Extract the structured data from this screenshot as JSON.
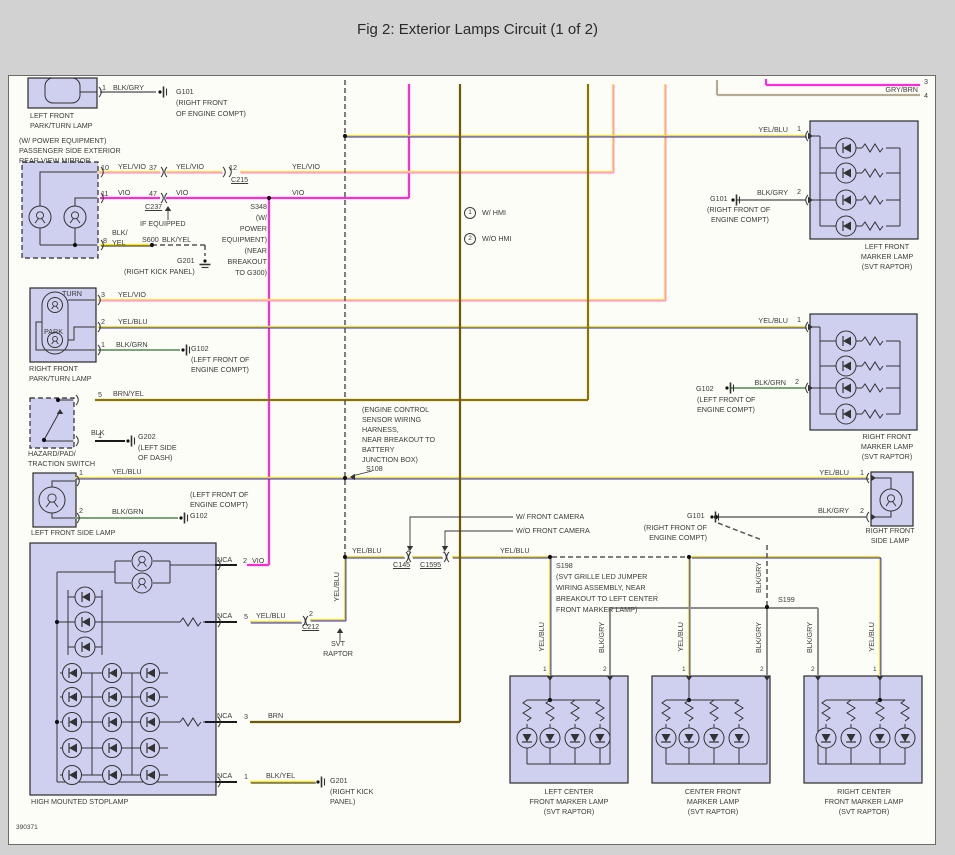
{
  "title": "Fig 2: Exterior Lamps Circuit (1 of 2)",
  "figure_number": "390371",
  "colors": {
    "page_bg": "#d2d2d2",
    "paper": "#fdfdf8",
    "paper_border": "#6a6a6a",
    "ink": "#333333",
    "text": "#3a3a3a",
    "box_fill": "#cfcfef",
    "box_stroke": "#2b2b2b",
    "vio": "#ff2bd6",
    "yelvio_base": "#ffd95e",
    "yelvio_stripe": "#ff7bdc",
    "yelblu_base": "#efdf2e",
    "yelblu_stripe": "#2a2ac8",
    "blkyel_base": "#ffe81a",
    "blkyel_stripe": "#222222",
    "brnyel": "#8a7500",
    "brn": "#6e5900",
    "blk": "#1a1a1a",
    "blkgry": "#8d8d8d",
    "blkgrn": "#7da37d",
    "grybrn": "#b5ab92",
    "dash": "#555555"
  },
  "components": [
    "LEFT FRONT PARK/TURN LAMP",
    "PASSENGER SIDE EXTERIOR REAR VIEW MIRROR (W/ POWER EQUIPMENT)",
    "RIGHT FRONT PARK/TURN LAMP",
    "HAZARD/PAD/TRACTION SWITCH",
    "LEFT FRONT SIDE LAMP",
    "HIGH MOUNTED STOPLAMP",
    "LEFT FRONT MARKER LAMP (SVT RAPTOR)",
    "RIGHT FRONT MARKER LAMP (SVT RAPTOR)",
    "RIGHT FRONT SIDE LAMP",
    "LEFT CENTER FRONT MARKER LAMP (SVT RAPTOR)",
    "CENTER FRONT MARKER LAMP (SVT RAPTOR)",
    "RIGHT CENTER FRONT MARKER LAMP (SVT RAPTOR)"
  ],
  "labels": [
    {
      "n": "a-pin-1",
      "t": "1",
      "x": 102,
      "y": 84
    },
    {
      "n": "a-wire-color",
      "t": "BLK/GRY",
      "x": 113,
      "y": 84
    },
    {
      "n": "g101-a",
      "t": "G101",
      "x": 176,
      "y": 88
    },
    {
      "n": "g101-a-loc1",
      "t": "(RIGHT FRONT",
      "x": 176,
      "y": 99
    },
    {
      "n": "g101-a-loc2",
      "t": "OF ENGINE COMPT)",
      "x": 176,
      "y": 110
    },
    {
      "n": "a-caption1",
      "t": "LEFT FRONT",
      "x": 30,
      "y": 112
    },
    {
      "n": "a-caption2",
      "t": "PARK/TURN LAMP",
      "x": 30,
      "y": 122
    },
    {
      "n": "mirror-caption1",
      "t": "(W/ POWER EQUIPMENT)",
      "x": 19,
      "y": 137
    },
    {
      "n": "mirror-caption2",
      "t": "PASSENGER SIDE EXTERIOR",
      "x": 19,
      "y": 147
    },
    {
      "n": "mirror-caption3",
      "t": "REAR VIEW MIRROR",
      "x": 19,
      "y": 157
    },
    {
      "n": "mirror-pin-10",
      "t": "10",
      "x": 101,
      "y": 164
    },
    {
      "n": "w-yelvio-1",
      "t": "YEL/VIO",
      "x": 118,
      "y": 163
    },
    {
      "n": "pin-37",
      "t": "37",
      "x": 149,
      "y": 164
    },
    {
      "n": "w-yelvio-2",
      "t": "YEL/VIO",
      "x": 176,
      "y": 163
    },
    {
      "n": "pin-12",
      "t": "12",
      "x": 229,
      "y": 164
    },
    {
      "n": "conn-c215",
      "t": "C215",
      "x": 231,
      "y": 176,
      "u": 1
    },
    {
      "n": "w-yelvio-3",
      "t": "YEL/VIO",
      "x": 292,
      "y": 163
    },
    {
      "n": "mirror-pin-11",
      "t": "11",
      "x": 101,
      "y": 190
    },
    {
      "n": "w-vio-1",
      "t": "VIO",
      "x": 118,
      "y": 189
    },
    {
      "n": "pin-47",
      "t": "47",
      "x": 149,
      "y": 190
    },
    {
      "n": "w-vio-2",
      "t": "VIO",
      "x": 176,
      "y": 189
    },
    {
      "n": "conn-c237",
      "t": "C237",
      "x": 145,
      "y": 203,
      "u": 1
    },
    {
      "n": "w-vio-3",
      "t": "VIO",
      "x": 292,
      "y": 189
    },
    {
      "n": "note-if-equipped",
      "t": "IF EQUIPPED",
      "x": 140,
      "y": 220
    },
    {
      "n": "mirror-pin-8",
      "t": "8",
      "x": 103,
      "y": 237
    },
    {
      "n": "w-blkyel-1a",
      "t": "BLK/",
      "x": 112,
      "y": 229
    },
    {
      "n": "w-blkyel-1b",
      "t": "YEL",
      "x": 112,
      "y": 239
    },
    {
      "n": "splice-s600",
      "t": "S600",
      "x": 142,
      "y": 236
    },
    {
      "n": "w-blkyel-2",
      "t": "BLK/YEL",
      "x": 162,
      "y": 236
    },
    {
      "n": "g201-a",
      "t": "G201",
      "x": 177,
      "y": 257
    },
    {
      "n": "g201-a-loc",
      "t": "(RIGHT KICK PANEL)",
      "x": 124,
      "y": 268
    },
    {
      "n": "splice-s348",
      "t": "S348",
      "x": 267,
      "y": 203,
      "a": "r"
    },
    {
      "n": "s348-note1",
      "t": "(W/",
      "x": 267,
      "y": 214,
      "a": "r"
    },
    {
      "n": "s348-note2",
      "t": "POWER",
      "x": 267,
      "y": 225,
      "a": "r"
    },
    {
      "n": "s348-note3",
      "t": "EQUIPMENT)",
      "x": 267,
      "y": 236,
      "a": "r"
    },
    {
      "n": "s348-note4",
      "t": "(NEAR",
      "x": 267,
      "y": 247,
      "a": "r"
    },
    {
      "n": "s348-note5",
      "t": "BREAKOUT",
      "x": 267,
      "y": 258,
      "a": "r"
    },
    {
      "n": "s348-note6",
      "t": "TO G300)",
      "x": 267,
      "y": 269,
      "a": "r"
    },
    {
      "n": "note-1-marker",
      "t": "1",
      "x": 464,
      "y": 207,
      "circ": 1
    },
    {
      "n": "note-1-text",
      "t": "W/ HMI",
      "x": 482,
      "y": 209
    },
    {
      "n": "note-2-marker",
      "t": "2",
      "x": 464,
      "y": 233,
      "circ": 1
    },
    {
      "n": "note-2-text",
      "t": "W/O HMI",
      "x": 482,
      "y": 235
    },
    {
      "n": "edge-pin-3",
      "t": "3",
      "x": 924,
      "y": 78
    },
    {
      "n": "w-grybrn",
      "t": "GRY/BRN",
      "x": 918,
      "y": 86,
      "a": "r"
    },
    {
      "n": "edge-pin-4",
      "t": "4",
      "x": 924,
      "y": 92
    },
    {
      "n": "w-yelblu-lfm",
      "t": "YEL/BLU",
      "x": 788,
      "y": 126,
      "a": "r"
    },
    {
      "n": "lfm-pin-1",
      "t": "1",
      "x": 797,
      "y": 125
    },
    {
      "n": "g101-b",
      "t": "G101",
      "x": 710,
      "y": 195
    },
    {
      "n": "w-blkgry-lfm",
      "t": "BLK/GRY",
      "x": 788,
      "y": 189,
      "a": "r"
    },
    {
      "n": "lfm-pin-2",
      "t": "2",
      "x": 797,
      "y": 188
    },
    {
      "n": "g101-b-loc1",
      "t": "(RIGHT FRONT OF",
      "x": 707,
      "y": 206
    },
    {
      "n": "g101-b-loc2",
      "t": "ENGINE COMPT)",
      "x": 711,
      "y": 216
    },
    {
      "n": "lfm-caption1",
      "t": "LEFT FRONT",
      "x": 887,
      "y": 243,
      "a": "c"
    },
    {
      "n": "lfm-caption2",
      "t": "MARKER LAMP",
      "x": 887,
      "y": 253,
      "a": "c"
    },
    {
      "n": "lfm-caption3",
      "t": "(SVT RAPTOR)",
      "x": 887,
      "y": 263,
      "a": "c"
    },
    {
      "n": "c-turn",
      "t": "TURN",
      "x": 62,
      "y": 290
    },
    {
      "n": "c-park",
      "t": "PARK",
      "x": 44,
      "y": 328
    },
    {
      "n": "c-pin-3",
      "t": "3",
      "x": 101,
      "y": 291
    },
    {
      "n": "w-yelvio-4",
      "t": "YEL/VIO",
      "x": 118,
      "y": 291
    },
    {
      "n": "c-pin-2",
      "t": "2",
      "x": 101,
      "y": 318
    },
    {
      "n": "w-yelblu-1",
      "t": "YEL/BLU",
      "x": 118,
      "y": 318
    },
    {
      "n": "c-pin-1",
      "t": "1",
      "x": 101,
      "y": 341
    },
    {
      "n": "w-blkgrn-1",
      "t": "BLK/GRN",
      "x": 116,
      "y": 341
    },
    {
      "n": "g102-a",
      "t": "G102",
      "x": 191,
      "y": 345
    },
    {
      "n": "g102-a-loc1",
      "t": "(LEFT FRONT OF",
      "x": 191,
      "y": 356
    },
    {
      "n": "g102-a-loc2",
      "t": "ENGINE COMPT)",
      "x": 191,
      "y": 366
    },
    {
      "n": "c-caption1",
      "t": "RIGHT FRONT",
      "x": 29,
      "y": 365
    },
    {
      "n": "c-caption2",
      "t": "PARK/TURN LAMP",
      "x": 29,
      "y": 375
    },
    {
      "n": "w-yelblu-rfm",
      "t": "YEL/BLU",
      "x": 788,
      "y": 317,
      "a": "r"
    },
    {
      "n": "rfm-pin-1",
      "t": "1",
      "x": 797,
      "y": 316
    },
    {
      "n": "g102-b",
      "t": "G102",
      "x": 696,
      "y": 385
    },
    {
      "n": "w-blkgrn-rfm",
      "t": "BLK/GRN",
      "x": 786,
      "y": 379,
      "a": "r"
    },
    {
      "n": "rfm-pin-2",
      "t": "2",
      "x": 795,
      "y": 378
    },
    {
      "n": "g102-b-loc1",
      "t": "(LEFT FRONT OF",
      "x": 697,
      "y": 396
    },
    {
      "n": "g102-b-loc2",
      "t": "ENGINE COMPT)",
      "x": 697,
      "y": 406
    },
    {
      "n": "rfm-caption1",
      "t": "RIGHT FRONT",
      "x": 887,
      "y": 433,
      "a": "c"
    },
    {
      "n": "rfm-caption2",
      "t": "MARKER LAMP",
      "x": 887,
      "y": 443,
      "a": "c"
    },
    {
      "n": "rfm-caption3",
      "t": "(SVT RAPTOR)",
      "x": 887,
      "y": 453,
      "a": "c"
    },
    {
      "n": "hz-pin-5",
      "t": "5",
      "x": 98,
      "y": 391
    },
    {
      "n": "w-brnyel",
      "t": "BRN/YEL",
      "x": 113,
      "y": 390
    },
    {
      "n": "hz-pin-1",
      "t": "1",
      "x": 98,
      "y": 432
    },
    {
      "n": "w-blk",
      "t": "BLK",
      "x": 91,
      "y": 429
    },
    {
      "n": "g202",
      "t": "G202",
      "x": 138,
      "y": 433
    },
    {
      "n": "g202-loc1",
      "t": "(LEFT SIDE",
      "x": 138,
      "y": 444
    },
    {
      "n": "g202-loc2",
      "t": "OF DASH)",
      "x": 138,
      "y": 454
    },
    {
      "n": "hz-caption1",
      "t": "HAZARD/PAD/",
      "x": 28,
      "y": 450
    },
    {
      "n": "hz-caption2",
      "t": "TRACTION SWITCH",
      "x": 28,
      "y": 460
    },
    {
      "n": "lfs-pin-1",
      "t": "1",
      "x": 79,
      "y": 469
    },
    {
      "n": "w-yelblu-2",
      "t": "YEL/BLU",
      "x": 112,
      "y": 468
    },
    {
      "n": "lfs-pin-2",
      "t": "2",
      "x": 79,
      "y": 507
    },
    {
      "n": "w-blkgrn-2",
      "t": "BLK/GRN",
      "x": 112,
      "y": 508
    },
    {
      "n": "g102-c-loc1",
      "t": "(LEFT FRONT OF",
      "x": 190,
      "y": 491
    },
    {
      "n": "g102-c-loc2",
      "t": "ENGINE COMPT)",
      "x": 190,
      "y": 501
    },
    {
      "n": "g102-c",
      "t": "G102",
      "x": 190,
      "y": 512
    },
    {
      "n": "lfs-caption",
      "t": "LEFT FRONT SIDE LAMP",
      "x": 31,
      "y": 529
    },
    {
      "n": "s108-note1",
      "t": "(ENGINE CONTROL",
      "x": 362,
      "y": 406
    },
    {
      "n": "s108-note2",
      "t": "SENSOR WIRING",
      "x": 362,
      "y": 416
    },
    {
      "n": "s108-note3",
      "t": "HARNESS,",
      "x": 362,
      "y": 426
    },
    {
      "n": "s108-note4",
      "t": "NEAR BREAKOUT TO",
      "x": 362,
      "y": 436
    },
    {
      "n": "s108-note5",
      "t": "BATTERY",
      "x": 362,
      "y": 446
    },
    {
      "n": "s108-note6",
      "t": "JUNCTION BOX)",
      "x": 362,
      "y": 456
    },
    {
      "n": "splice-s108",
      "t": "S108",
      "x": 366,
      "y": 465
    },
    {
      "n": "w-yelblu-rfs",
      "t": "YEL/BLU",
      "x": 849,
      "y": 469,
      "a": "r"
    },
    {
      "n": "rfs-pin-1",
      "t": "1",
      "x": 860,
      "y": 469
    },
    {
      "n": "g101-c",
      "t": "G101",
      "x": 687,
      "y": 512
    },
    {
      "n": "w-blkgry-rfs",
      "t": "BLK/GRY",
      "x": 849,
      "y": 507,
      "a": "r"
    },
    {
      "n": "rfs-pin-2",
      "t": "2",
      "x": 860,
      "y": 507
    },
    {
      "n": "g101-c-loc1",
      "t": "(RIGHT FRONT OF",
      "x": 707,
      "y": 524,
      "a": "r"
    },
    {
      "n": "g101-c-loc2",
      "t": "ENGINE COMPT)",
      "x": 707,
      "y": 534,
      "a": "r"
    },
    {
      "n": "rfs-caption1",
      "t": "RIGHT FRONT",
      "x": 890,
      "y": 527,
      "a": "c"
    },
    {
      "n": "rfs-caption2",
      "t": "SIDE LAMP",
      "x": 890,
      "y": 537,
      "a": "c"
    },
    {
      "n": "note-w-front-camera",
      "t": "W/ FRONT CAMERA",
      "x": 516,
      "y": 513
    },
    {
      "n": "note-wo-front-camera",
      "t": "W/O FRONT CAMERA",
      "x": 516,
      "y": 527
    },
    {
      "n": "w-yelblu-3",
      "t": "YEL/BLU",
      "x": 352,
      "y": 547
    },
    {
      "n": "c145-pin-4",
      "t": "4",
      "x": 407,
      "y": 547
    },
    {
      "n": "c1595-pin-1",
      "t": "1",
      "x": 442,
      "y": 547
    },
    {
      "n": "conn-c145",
      "t": "C145",
      "x": 393,
      "y": 561,
      "u": 1
    },
    {
      "n": "conn-c1595",
      "t": "C1595",
      "x": 420,
      "y": 561,
      "u": 1
    },
    {
      "n": "w-yelblu-4",
      "t": "YEL/BLU",
      "x": 500,
      "y": 547
    },
    {
      "n": "splice-s198",
      "t": "S198",
      "x": 556,
      "y": 562
    },
    {
      "n": "s198-note1",
      "t": "(SVT GRILLE LED JUMPER",
      "x": 556,
      "y": 573
    },
    {
      "n": "s198-note2",
      "t": "WIRING ASSEMBLY, NEAR",
      "x": 556,
      "y": 584
    },
    {
      "n": "s198-note3",
      "t": "BREAKOUT TO LEFT CENTER",
      "x": 556,
      "y": 595
    },
    {
      "n": "s198-note4",
      "t": "FRONT MARKER LAMP)",
      "x": 556,
      "y": 606
    },
    {
      "n": "splice-s199",
      "t": "S199",
      "x": 778,
      "y": 596
    },
    {
      "n": "hms-nca-2l",
      "t": "NCA",
      "x": 217,
      "y": 556
    },
    {
      "n": "hms-pin-2",
      "t": "2",
      "x": 243,
      "y": 557
    },
    {
      "n": "w-vio-4",
      "t": "VIO",
      "x": 252,
      "y": 557
    },
    {
      "n": "hms-nca-5l",
      "t": "NCA",
      "x": 217,
      "y": 612
    },
    {
      "n": "hms-pin-5",
      "t": "5",
      "x": 244,
      "y": 613
    },
    {
      "n": "w-yelblu-5",
      "t": "YEL/BLU",
      "x": 256,
      "y": 612
    },
    {
      "n": "c212-pin-2",
      "t": "2",
      "x": 309,
      "y": 610
    },
    {
      "n": "conn-c212",
      "t": "C212",
      "x": 302,
      "y": 623,
      "u": 1
    },
    {
      "n": "note-svt1",
      "t": "SVT",
      "x": 338,
      "y": 640,
      "a": "c"
    },
    {
      "n": "note-svt2",
      "t": "RAPTOR",
      "x": 338,
      "y": 650,
      "a": "c"
    },
    {
      "n": "hms-nca-3l",
      "t": "NCA",
      "x": 217,
      "y": 712
    },
    {
      "n": "hms-pin-3",
      "t": "3",
      "x": 244,
      "y": 713
    },
    {
      "n": "w-brn",
      "t": "BRN",
      "x": 268,
      "y": 712
    },
    {
      "n": "hms-nca-1l",
      "t": "NCA",
      "x": 217,
      "y": 772
    },
    {
      "n": "hms-pin-1",
      "t": "1",
      "x": 244,
      "y": 773
    },
    {
      "n": "w-blkyel-3",
      "t": "BLK/YEL",
      "x": 266,
      "y": 772
    },
    {
      "n": "g201-b",
      "t": "G201",
      "x": 330,
      "y": 777
    },
    {
      "n": "g201-b-loc1",
      "t": "(RIGHT KICK",
      "x": 330,
      "y": 788
    },
    {
      "n": "g201-b-loc2",
      "t": "PANEL)",
      "x": 330,
      "y": 798
    },
    {
      "n": "hms-caption",
      "t": "HIGH MOUNTED STOPLAMP",
      "x": 31,
      "y": 798
    },
    {
      "n": "v-yelblu-c212",
      "t": "YEL/BLU",
      "x": 333,
      "y": 572,
      "v": 1
    },
    {
      "n": "v-yelblu-lc",
      "t": "YEL/BLU",
      "x": 538,
      "y": 622,
      "v": 1
    },
    {
      "n": "v-blkgry-lc",
      "t": "BLK/GRY",
      "x": 598,
      "y": 622,
      "v": 1
    },
    {
      "n": "v-yelblu-cf",
      "t": "YEL/BLU",
      "x": 677,
      "y": 622,
      "v": 1
    },
    {
      "n": "v-blkgry-s199a",
      "t": "BLK/GRY",
      "x": 755,
      "y": 562,
      "v": 1
    },
    {
      "n": "v-blkgry-cf",
      "t": "BLK/GRY",
      "x": 755,
      "y": 622,
      "v": 1
    },
    {
      "n": "v-blkgry-rc",
      "t": "BLK/GRY",
      "x": 806,
      "y": 622,
      "v": 1
    },
    {
      "n": "v-yelblu-rc",
      "t": "YEL/BLU",
      "x": 868,
      "y": 622,
      "v": 1
    },
    {
      "n": "lc-pin-1",
      "t": "1",
      "x": 543,
      "y": 666,
      "fs": 6.5
    },
    {
      "n": "lc-pin-2",
      "t": "2",
      "x": 603,
      "y": 666,
      "fs": 6.5
    },
    {
      "n": "cf-pin-1",
      "t": "1",
      "x": 682,
      "y": 666,
      "fs": 6.5
    },
    {
      "n": "cf-pin-2",
      "t": "2",
      "x": 760,
      "y": 666,
      "fs": 6.5
    },
    {
      "n": "rc-pin-2",
      "t": "2",
      "x": 811,
      "y": 666,
      "fs": 6.5
    },
    {
      "n": "rc-pin-1",
      "t": "1",
      "x": 873,
      "y": 666,
      "fs": 6.5
    },
    {
      "n": "lc-caption1",
      "t": "LEFT CENTER",
      "x": 569,
      "y": 788,
      "a": "c"
    },
    {
      "n": "lc-caption2",
      "t": "FRONT MARKER LAMP",
      "x": 569,
      "y": 798,
      "a": "c"
    },
    {
      "n": "lc-caption3",
      "t": "(SVT RAPTOR)",
      "x": 569,
      "y": 808,
      "a": "c"
    },
    {
      "n": "cf-caption1",
      "t": "CENTER FRONT",
      "x": 713,
      "y": 788,
      "a": "c"
    },
    {
      "n": "cf-caption2",
      "t": "MARKER LAMP",
      "x": 713,
      "y": 798,
      "a": "c"
    },
    {
      "n": "cf-caption3",
      "t": "(SVT RAPTOR)",
      "x": 713,
      "y": 808,
      "a": "c"
    },
    {
      "n": "rc-caption1",
      "t": "RIGHT CENTER",
      "x": 864,
      "y": 788,
      "a": "c"
    },
    {
      "n": "rc-caption2",
      "t": "FRONT MARKER LAMP",
      "x": 864,
      "y": 798,
      "a": "c"
    },
    {
      "n": "rc-caption3",
      "t": "(SVT RAPTOR)",
      "x": 864,
      "y": 808,
      "a": "c"
    }
  ]
}
